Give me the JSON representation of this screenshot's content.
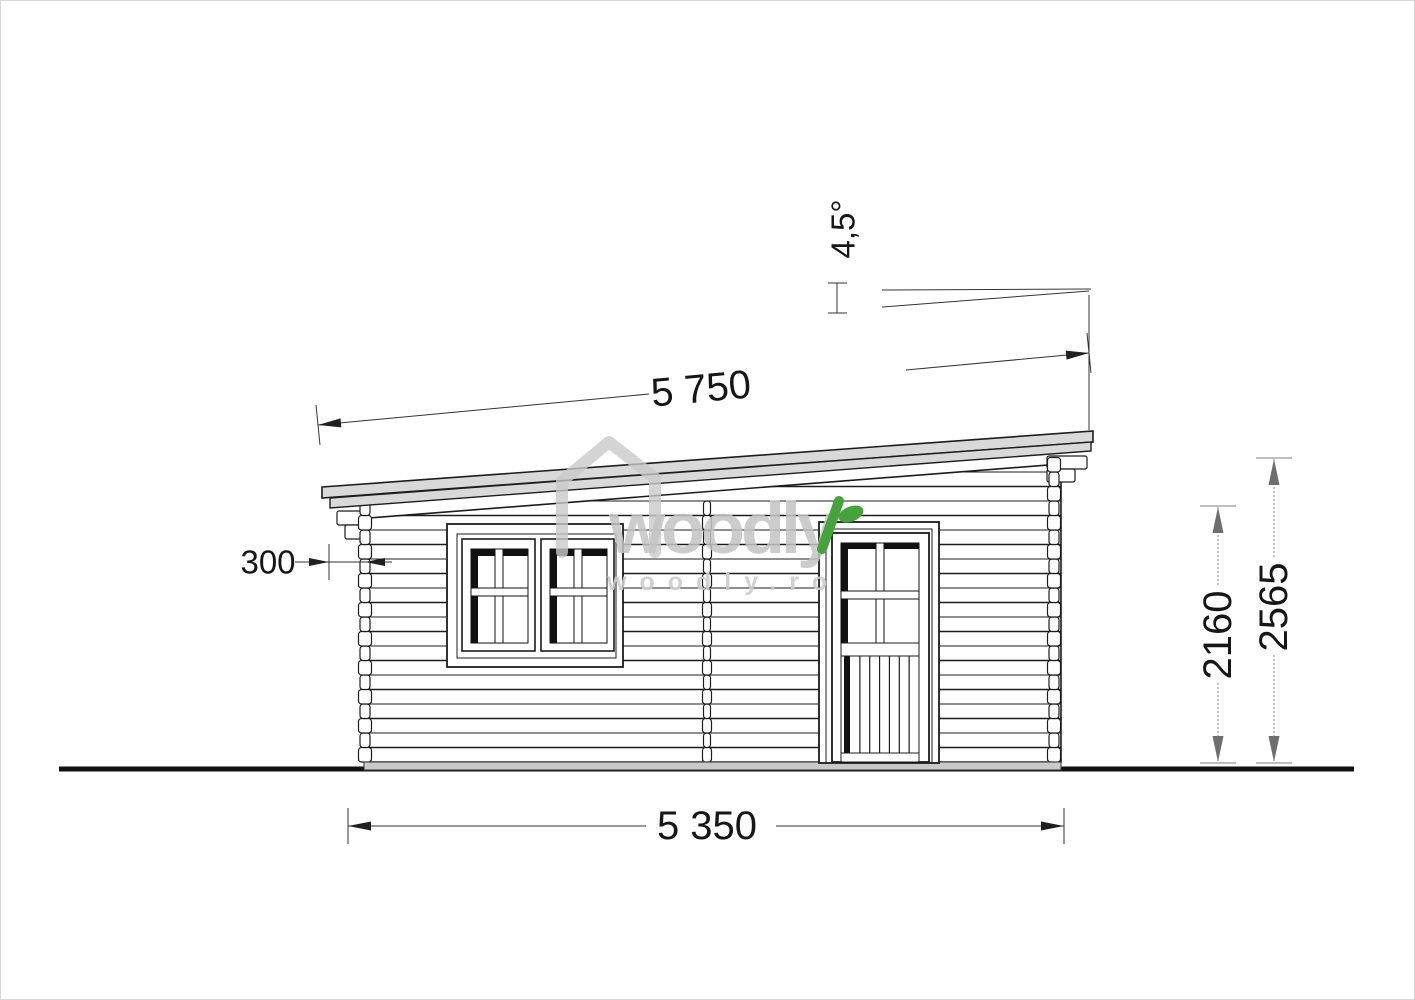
{
  "dimensions": {
    "roof_length": "5 750",
    "overhang": "300",
    "roof_angle": "4,5°",
    "wall_height": "2160",
    "overall_height": "2565",
    "wall_length": "5 350"
  },
  "watermark": {
    "brand": "woodly",
    "domain": "woodly.ro"
  },
  "colors": {
    "roof_fill": "#d9d9d9",
    "foundation_fill": "#c9c9c9",
    "leaf_green": "#46a33c",
    "watermark_gray": "#c9c9c9",
    "dim_dark": "#1f1f1f",
    "dim_gray": "#6e6e6e",
    "dim_gray_tick": "#aaaaaa"
  }
}
